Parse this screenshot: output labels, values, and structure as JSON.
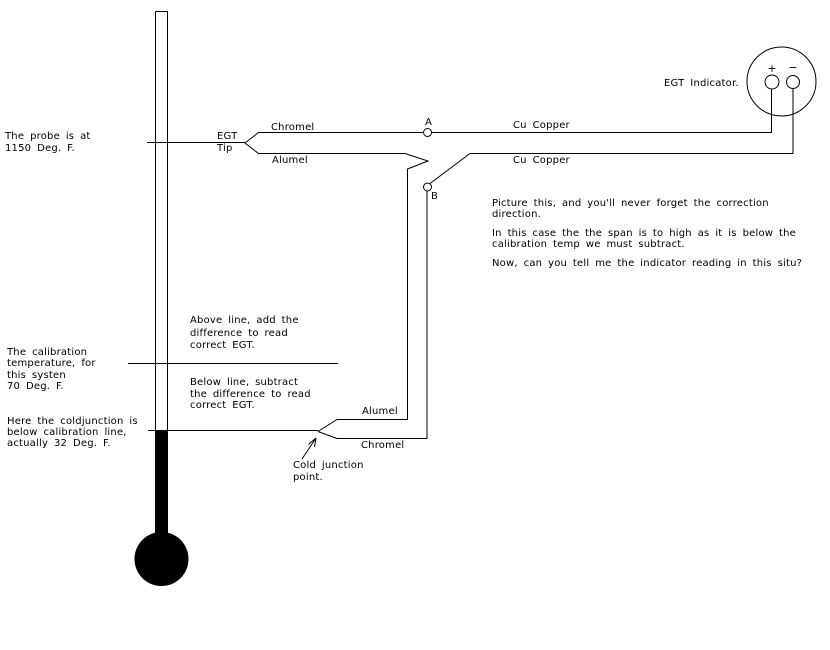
{
  "canvas": {
    "background": "#ffffff",
    "ink": "#000000"
  },
  "probe_note": {
    "lines": [
      "The probe is at",
      "1150 Deg. F."
    ]
  },
  "probe": {
    "egt_tip": {
      "lines": [
        "EGT",
        "Tip"
      ]
    },
    "chromel_label": "Chromel",
    "alumel_label": "Alumel",
    "junction_a": "A",
    "junction_b": "B"
  },
  "copper": {
    "top_label": "Cu Copper",
    "mid_label": "Cu Copper"
  },
  "indicator": {
    "label": "EGT Indicator.",
    "plus": "+",
    "minus": "−"
  },
  "narration": {
    "p1": {
      "lines": [
        "Picture this, and you'll never forget the correction",
        "direction."
      ]
    },
    "p2": {
      "lines": [
        "In this case the the span is to high as it is below the",
        "calibration temp we must subtract."
      ]
    },
    "p3": {
      "lines": [
        "Now, can you tell me the indicator reading in this situ?"
      ]
    }
  },
  "correction_notes": {
    "above": {
      "lines": [
        "Above line, add the",
        "difference to read",
        "correct EGT."
      ]
    },
    "below": {
      "lines": [
        "Below line, subtract",
        "the difference to read",
        "correct EGT."
      ]
    }
  },
  "calibration_note": {
    "lines": [
      "The calibration",
      "temperature, for",
      "this systen",
      "70 Deg. F."
    ]
  },
  "cold_note": {
    "lines": [
      "Here the coldjunction is",
      "below calibration line,",
      "actually 32 Deg. F."
    ]
  },
  "cold_junction": {
    "alumel_label": "Alumel",
    "chromel_label": "Chromel",
    "point_label": {
      "lines": [
        "Cold junction",
        "point."
      ]
    }
  }
}
